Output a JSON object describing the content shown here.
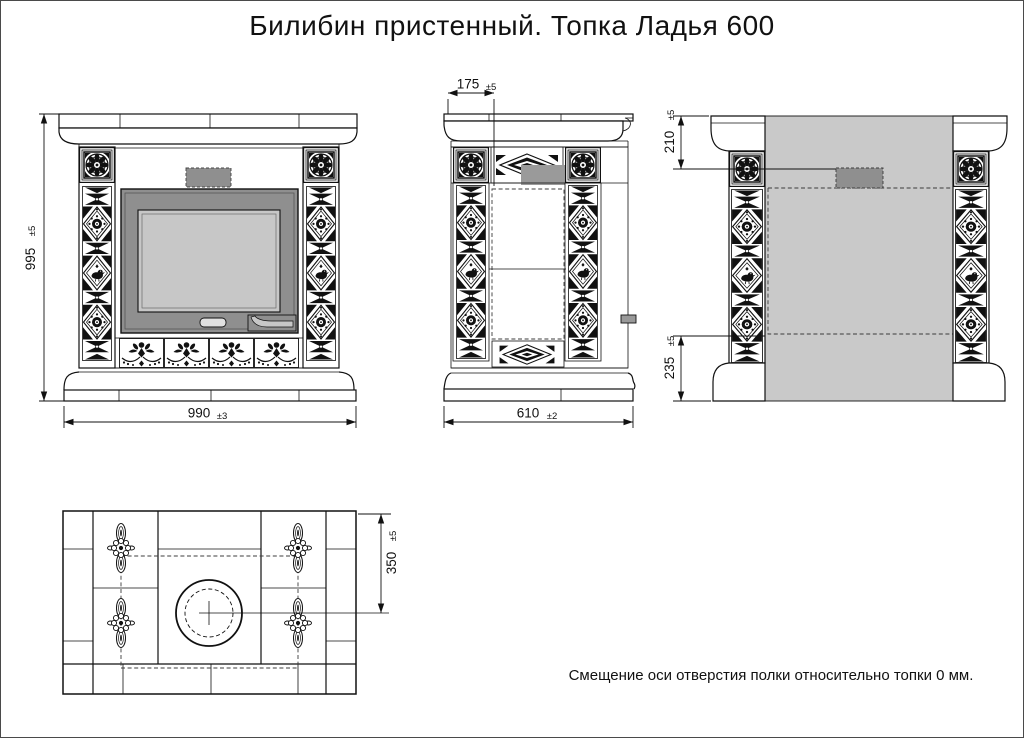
{
  "page": {
    "title": "Билибин пристенный. Топка Ладья 600",
    "note": "Смещение оси отверстия полки относительно топки 0 мм."
  },
  "dimensions": {
    "front_height": {
      "value": "995",
      "tol": "±5"
    },
    "front_width": {
      "value": "990",
      "tol": "±3"
    },
    "side_top": {
      "value": "175",
      "tol": "±5"
    },
    "side_depth": {
      "value": "610",
      "tol": "±2"
    },
    "back_top": {
      "value": "210",
      "tol": "±5"
    },
    "back_bottom": {
      "value": "235",
      "tol": "±5"
    },
    "shelf_hole": {
      "value": "350",
      "tol": "±5"
    }
  },
  "colors": {
    "line": "#111111",
    "firebox_frame": "#8f8f8f",
    "glass": "#c7c7c7",
    "wall_light": "#c9c9c9",
    "wall_dark": "#989898"
  }
}
